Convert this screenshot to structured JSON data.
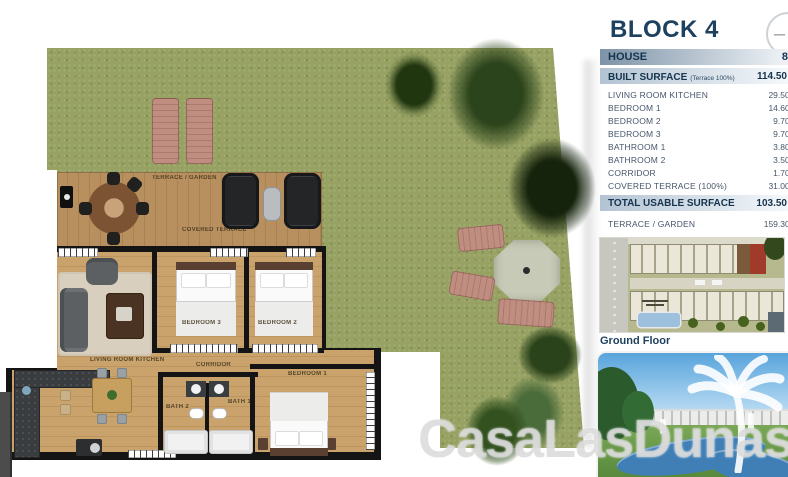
{
  "panel": {
    "title": "BLOCK 4",
    "minus_icon": "–",
    "house_row": {
      "label": "HOUSE",
      "value": "8"
    },
    "built_row": {
      "label": "BUILT SURFACE",
      "note": "(Terrace 100%)",
      "value": "114.50 m²"
    },
    "rooms": [
      {
        "label": "LIVING ROOM KITCHEN",
        "value": "29.50 m²"
      },
      {
        "label": "BEDROOM 1",
        "value": "14.60 m²"
      },
      {
        "label": "BEDROOM 2",
        "value": "9.70 m²"
      },
      {
        "label": "BEDROOM 3",
        "value": "9.70 m²"
      },
      {
        "label": "BATHROOM 1",
        "value": "3.80 m²"
      },
      {
        "label": "BATHROOM 2",
        "value": "3.50 m²"
      },
      {
        "label": "CORRIDOR",
        "value": "1.70 m²"
      },
      {
        "label": "COVERED TERRACE (100%)",
        "value": "31.00 m²"
      }
    ],
    "total_row": {
      "label": "TOTAL USABLE SURFACE",
      "value": "103.50 m²"
    },
    "terrace_row": {
      "label": "TERRACE / GARDEN",
      "value": "159.30 m²"
    },
    "ground_floor_label": "Ground Floor"
  },
  "floorplan": {
    "labels": {
      "terrace_garden": "TERRACE / GARDEN",
      "covered_terrace": "COVERED TERRACE",
      "living": "LIVING ROOM KITCHEN",
      "bedroom1": "BEDROOM 1",
      "bedroom2": "BEDROOM 2",
      "bedroom3": "BEDROOM 3",
      "bath1": "BATH 1",
      "bath2": "BATH 2",
      "corridor": "CORRIDOR"
    }
  },
  "watermark": "CasaLasDunas",
  "colors": {
    "heading_navy": "#1d415e",
    "grass_green": "#96a162",
    "deck_wood": "#b88f5e",
    "highlight_red": "#a03a2a",
    "pool_blue": "#9cc0dd",
    "row_gradient_dark": "#7d93a7",
    "row_gradient_light": "#b3c3d2"
  }
}
